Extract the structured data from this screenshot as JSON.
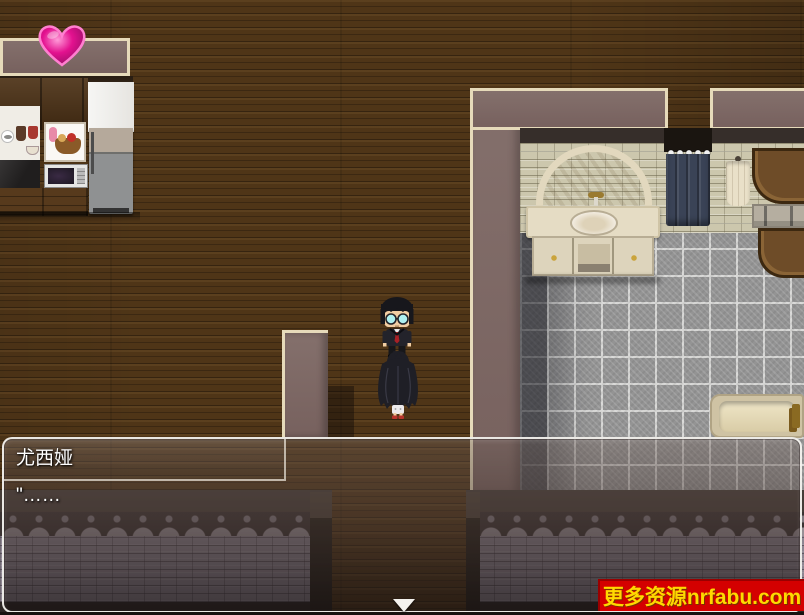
{
  "scene": {
    "label": "house-interior-hallway-kitchen-bathroom",
    "hud": {
      "heart_icon": "pink-heart-balloon"
    },
    "sprites": {
      "man": "black-haired-man-with-glasses-dark-suit-red-tie",
      "girl": "long-black-haired-girl-back-view-white-skirt-red-shoes"
    }
  },
  "dialogue": {
    "speaker": "尤西娅",
    "text": "\"……"
  },
  "watermark": {
    "text": "更多资源nrfabu.com"
  },
  "colors": {
    "wood_floor": "#4f3517",
    "wall_mauve": "#7d6663",
    "wall_trim": "#e6daba",
    "brick_cream": "#ccc7ad",
    "tile_gray": "#949494",
    "curtain_navy": "#3a4356",
    "stone_wall": "#8d8591",
    "dialog_border": "#faf8f4",
    "watermark_bg": "#d40000",
    "watermark_text": "#ffd800",
    "heart_pink": "#e3118f"
  }
}
